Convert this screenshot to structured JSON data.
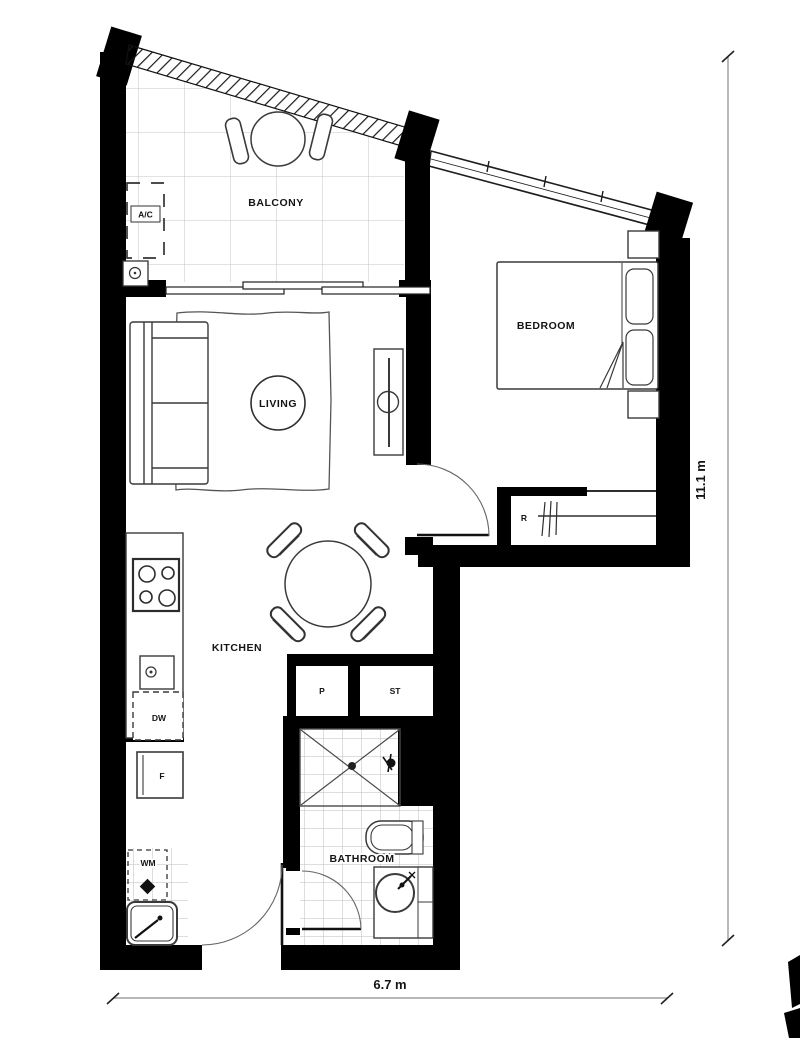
{
  "plan": {
    "title": "One-bedroom apartment floor plan",
    "rooms": {
      "balcony": "BALCONY",
      "living": "LIVING",
      "bedroom": "BEDROOM",
      "kitchen": "KITCHEN",
      "bathroom": "BATHROOM"
    },
    "fixtures": {
      "ac": "A/C",
      "robe": "R",
      "pantry": "P",
      "storage": "ST",
      "dishwasher": "DW",
      "fridge": "F",
      "washing_machine": "WM"
    },
    "dimensions": {
      "height_label": "11.1 m",
      "width_label": "6.7 m"
    },
    "colors": {
      "wall": "#000000",
      "line": "#3a3a3a",
      "tile": "#c4c4c4",
      "background": "#ffffff"
    }
  }
}
